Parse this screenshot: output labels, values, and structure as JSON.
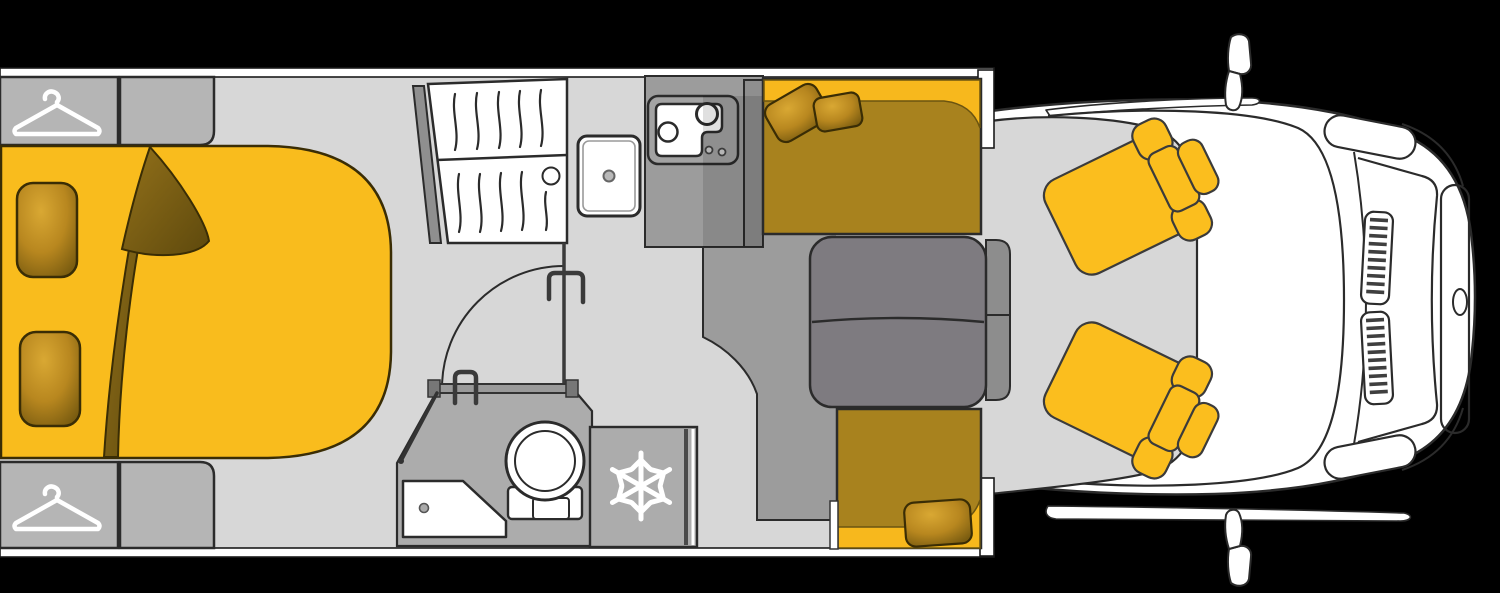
{
  "meta": {
    "description": "Motorhome floor plan, top view, on black background",
    "canvas_width": "1500",
    "canvas_height": "593"
  },
  "colors": {
    "bg": "#000000",
    "white": "#ffffff",
    "outline": "#2b2b2b",
    "floor": "#d7d7d7",
    "cabinet": "#b5b5b5",
    "counter": "#9c9c9c",
    "bathroom": "#acacac",
    "darkgray": "#8f8f8f",
    "table": "#7e7b80",
    "console": "#8d8d8d",
    "yellow": "#f9bc1d",
    "seat_yellow": "#fbbe1e",
    "olive": "#a8821e",
    "bright_back": "#f7b81d",
    "gold_light": "#d9a833",
    "gold_mid": "#b8871f",
    "gold_dark": "#7a5c10",
    "blanket_light": "#93711a",
    "blanket_dark": "#5e490d",
    "icon_white": "#ffffff",
    "slat": "#3f3f3f"
  },
  "icons": [
    {
      "name": "hanger-icon",
      "location": "front-wardrobe"
    },
    {
      "name": "hanger-icon",
      "location": "rear-wardrobe"
    },
    {
      "name": "snowflake-icon",
      "location": "refrigerator"
    }
  ],
  "features": [
    "rear-wardrobes",
    "double-bed",
    "pillows",
    "folded-blanket",
    "shower-cabin",
    "washbasin-cabinet",
    "kitchen-counter",
    "kitchen-sink-hob",
    "bathroom",
    "corner-basin",
    "toilet",
    "refrigerator",
    "dinette-front-bench",
    "dinette-rear-bench",
    "dinette-table",
    "cab-console",
    "driver-seat",
    "passenger-seat",
    "cab-body",
    "windshield",
    "grille-vents",
    "front-bumper-panel",
    "side-mirrors",
    "brand-badge"
  ]
}
